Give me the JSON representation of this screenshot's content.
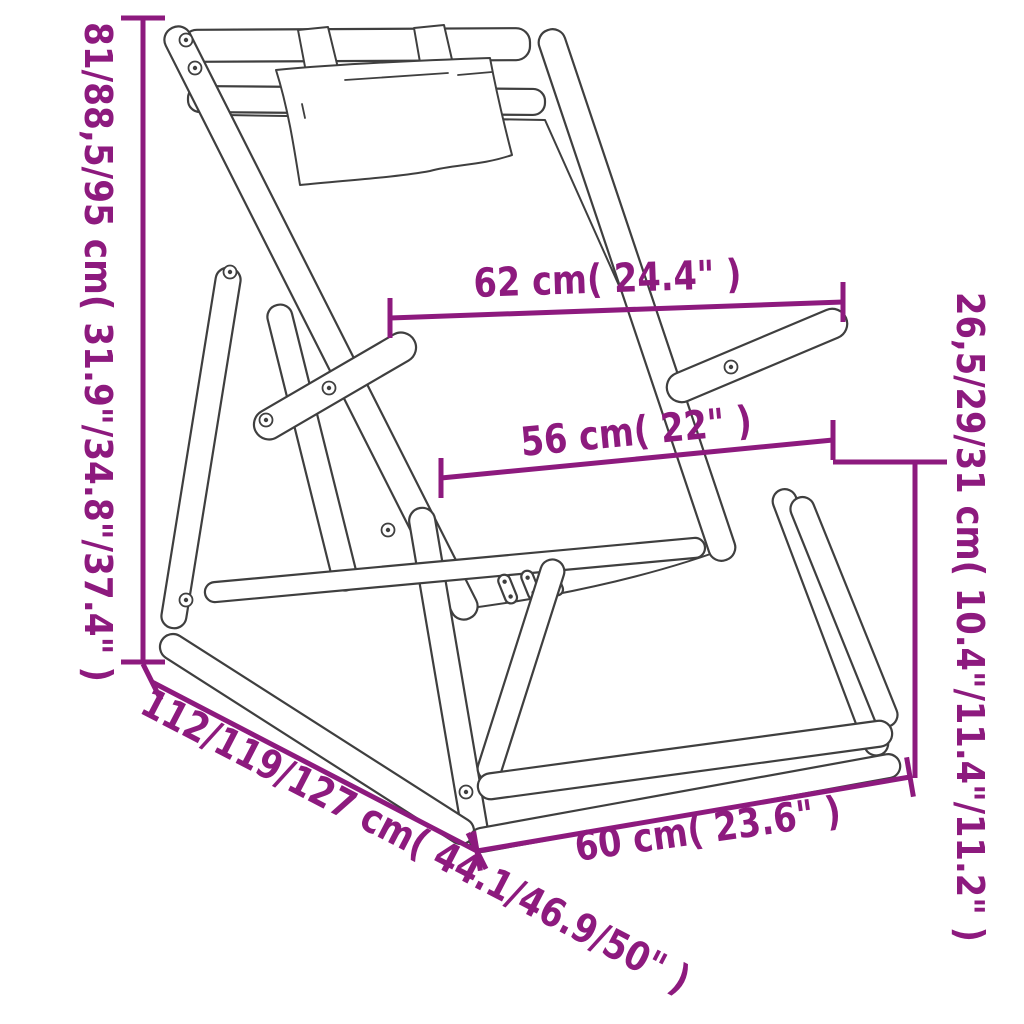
{
  "figure": {
    "title": "Deck chair dimension diagram",
    "product": "Folding wooden deck chair with headrest pillow",
    "accent_color": "#8d1a7e",
    "outline_color": "#3f3f3f",
    "background_color": "#ffffff"
  },
  "dimensions": {
    "total_height": "81/88,5/95 cm( 31.9\"/34.8\"/37.4\" )",
    "back_width": "62 cm( 24.4\" )",
    "seat_width": "56 cm( 22\" )",
    "armrest_height": "26,5/29/31 cm( 10.4\"/11.4\"/11.2\" )",
    "total_depth": "112/119/127 cm( 44.1/46.9/50\" )",
    "base_width": "60 cm( 23.6\" )"
  }
}
